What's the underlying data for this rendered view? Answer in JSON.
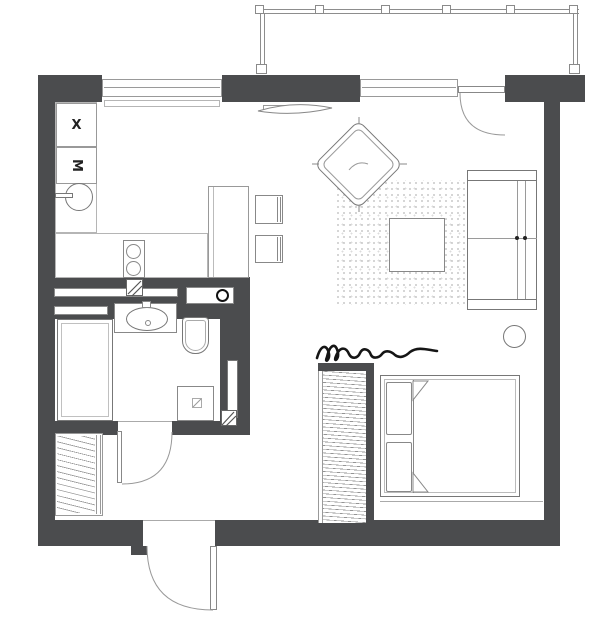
{
  "plan": {
    "type": "studio-apartment-floor-plan",
    "labels": {
      "appliance_x": "X",
      "appliance_m": "M"
    },
    "colors": {
      "wall": "#4b4c4e",
      "line": "#8a8a8a",
      "dark_line": "#6e6e6e",
      "ink": "#161616",
      "rug_dot": "#c9c9c9",
      "background": "#ffffff"
    },
    "inventory": [
      "balcony-railing",
      "kitchen-window",
      "living-room-window",
      "balcony-door",
      "appliance-x",
      "appliance-m",
      "kitchen-sink",
      "kitchen-counter",
      "stove",
      "kitchen-island",
      "bar-stool",
      "bar-stool",
      "tv",
      "armchair",
      "rug",
      "coffee-table",
      "sofa",
      "round-side-table",
      "shelf",
      "washing-machine",
      "bathtub",
      "washbasin",
      "toilet",
      "shower-tray",
      "bathroom-door",
      "hall-wardrobe",
      "entrance-door",
      "curtain-divider",
      "bedroom-wardrobe",
      "double-bed",
      "pillow",
      "pillow"
    ]
  }
}
